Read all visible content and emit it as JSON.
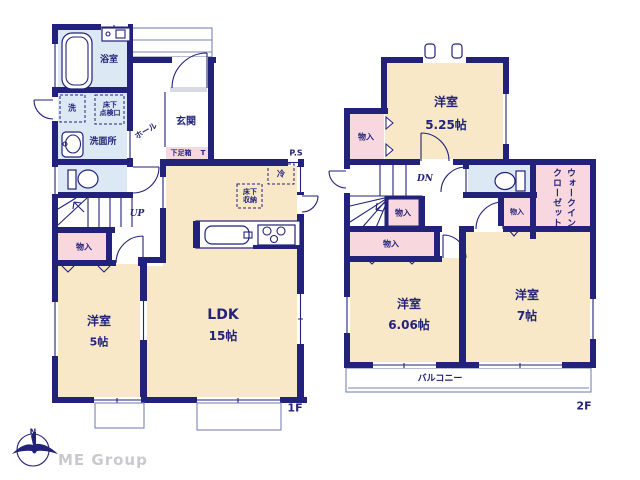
{
  "colors": {
    "wall": "#22227b",
    "room": "#f8e8c8",
    "water": "#dce8f4",
    "closet": "#f8d8de",
    "out": "#7a84b5",
    "ink": "#23237a",
    "brand": "#c9c9ce"
  },
  "floor1": {
    "floor_label": "1F",
    "bath": "浴室",
    "washer": "洗",
    "inspection_l1": "床下",
    "inspection_l2": "点検口",
    "washroom": "洗面所",
    "hall": "ホール",
    "entrance": "玄関",
    "shoe_box": "下足箱",
    "shoe_t": "T",
    "up": "UP",
    "storage": "物入",
    "west5_name": "洋室",
    "west5_size": "5帖",
    "ldk_name": "LDK",
    "ldk_size": "15帖",
    "fridge": "冷",
    "underfloor_l1": "床下",
    "underfloor_l2": "収納",
    "ps": "P.S"
  },
  "floor2": {
    "floor_label": "2F",
    "west525_name": "洋室",
    "west525_size": "5.25帖",
    "dn": "DN",
    "storage_a": "物入",
    "storage_b": "物入",
    "storage_c": "物入",
    "storage_d": "物入",
    "wic_l1": "ウォークイン",
    "wic_l2": "クローゼット",
    "west7_name": "洋室",
    "west7_size": "7帖",
    "west606_name": "洋室",
    "west606_size": "6.06帖",
    "balcony": "バルコニー"
  },
  "footer": {
    "brand": "ME Group",
    "compass_north": "N"
  }
}
